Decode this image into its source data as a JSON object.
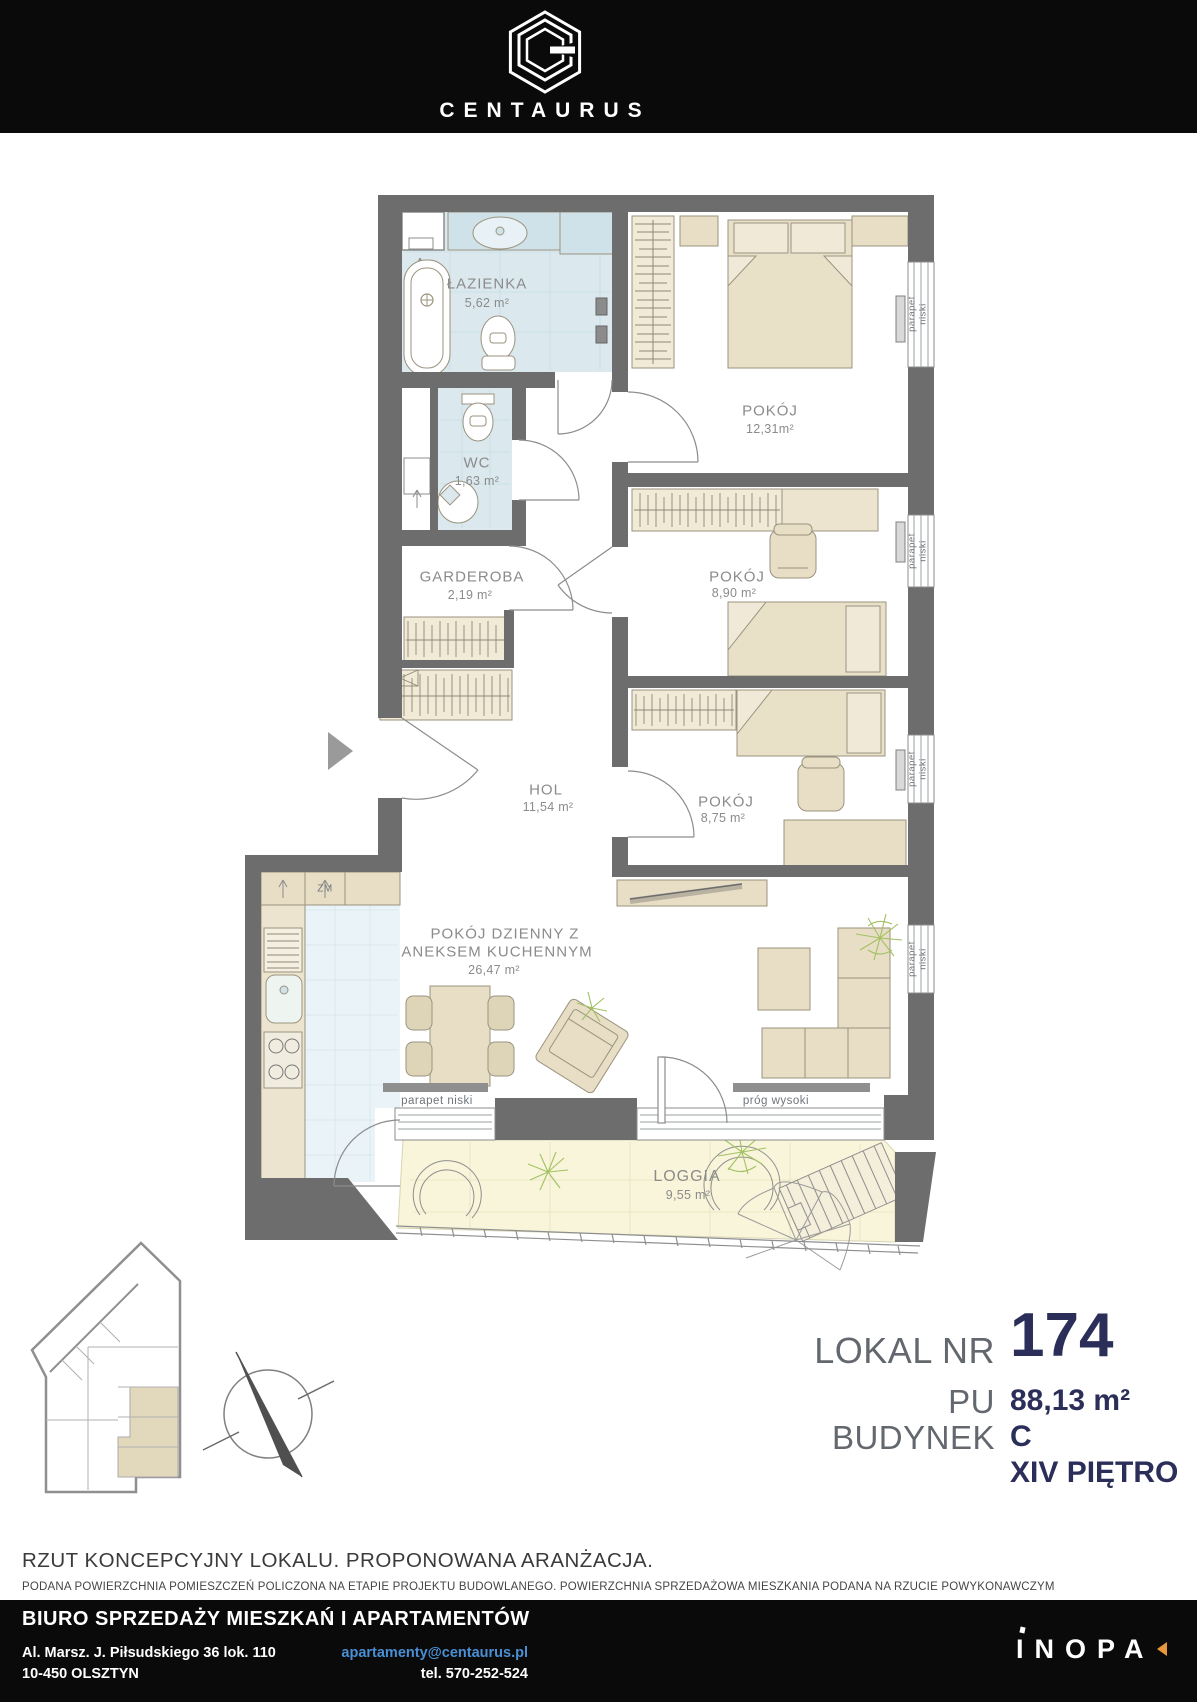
{
  "header": {
    "brand": "CENTAURUS"
  },
  "plan": {
    "rooms": {
      "lazienka": {
        "name": "ŁAZIENKA",
        "area": "5,62 m²"
      },
      "wc": {
        "name": "WC",
        "area": "1,63 m²"
      },
      "garderoba": {
        "name": "GARDEROBA",
        "area": "2,19 m²"
      },
      "pokoj_12": {
        "name": "POKÓJ",
        "area": "12,31m²"
      },
      "pokoj_890": {
        "name": "POKÓJ",
        "area": "8,90 m²"
      },
      "hol": {
        "name": "HOL",
        "area": "11,54 m²"
      },
      "pokoj_875": {
        "name": "POKÓJ",
        "area": "8,75 m²"
      },
      "dzienny": {
        "name_line1": "POKÓJ DZIENNY Z",
        "name_line2": "ANEKSEM KUCHENNYM",
        "area": "26,47 m²"
      },
      "loggia": {
        "name": "LOGGIA",
        "area": "9,55 m²"
      }
    },
    "annotations": {
      "parapet_word1": "parapet",
      "parapet_word2": "niski",
      "parapet_niski": "parapet niski",
      "prog_wysoki": "próg  wysoki",
      "zm": "ZM"
    }
  },
  "info": {
    "lokal_label": "LOKAL NR",
    "lokal_value": "174",
    "pu_label": "PU",
    "pu_value": "88,13 m²",
    "budynek_label": "BUDYNEK",
    "budynek_value": "C",
    "pietro_value": "XIV PIĘTRO"
  },
  "disclaimer": {
    "line1": "RZUT KONCEPCYJNY LOKALU. PROPONOWANA ARANŻACJA.",
    "line2": "PODANA POWIERZCHNIA POMIESZCZEŃ POLICZONA NA ETAPIE PROJEKTU BUDOWLANEGO. POWIERZCHNIA SPRZEDAŻOWA MIESZKANIA PODANA NA RZUCIE POWYKONAWCZYM"
  },
  "footer": {
    "title": "BIURO SPRZEDAŻY MIESZKAŃ I APARTAMENTÓW",
    "address_line1": "Al. Marsz. J. Piłsudskiego 36 lok. 110",
    "address_line2": "10-450 OLSZTYN",
    "email": "apartamenty@centaurus.pl",
    "phone": "tel. 570-252-524",
    "logo": "INOPA"
  },
  "colors": {
    "navy": "#2b2e58",
    "label_gray": "#8b8b8b",
    "wall_gray": "#6d6d6d",
    "bath_tile": "#dbe8ee",
    "kitchen_tile": "#eaf3f7",
    "furniture_tan": "#e7dec5",
    "loggia_floor": "#f8f5da",
    "email_blue": "#4a8fd4",
    "inopa_orange": "#e8973a"
  }
}
